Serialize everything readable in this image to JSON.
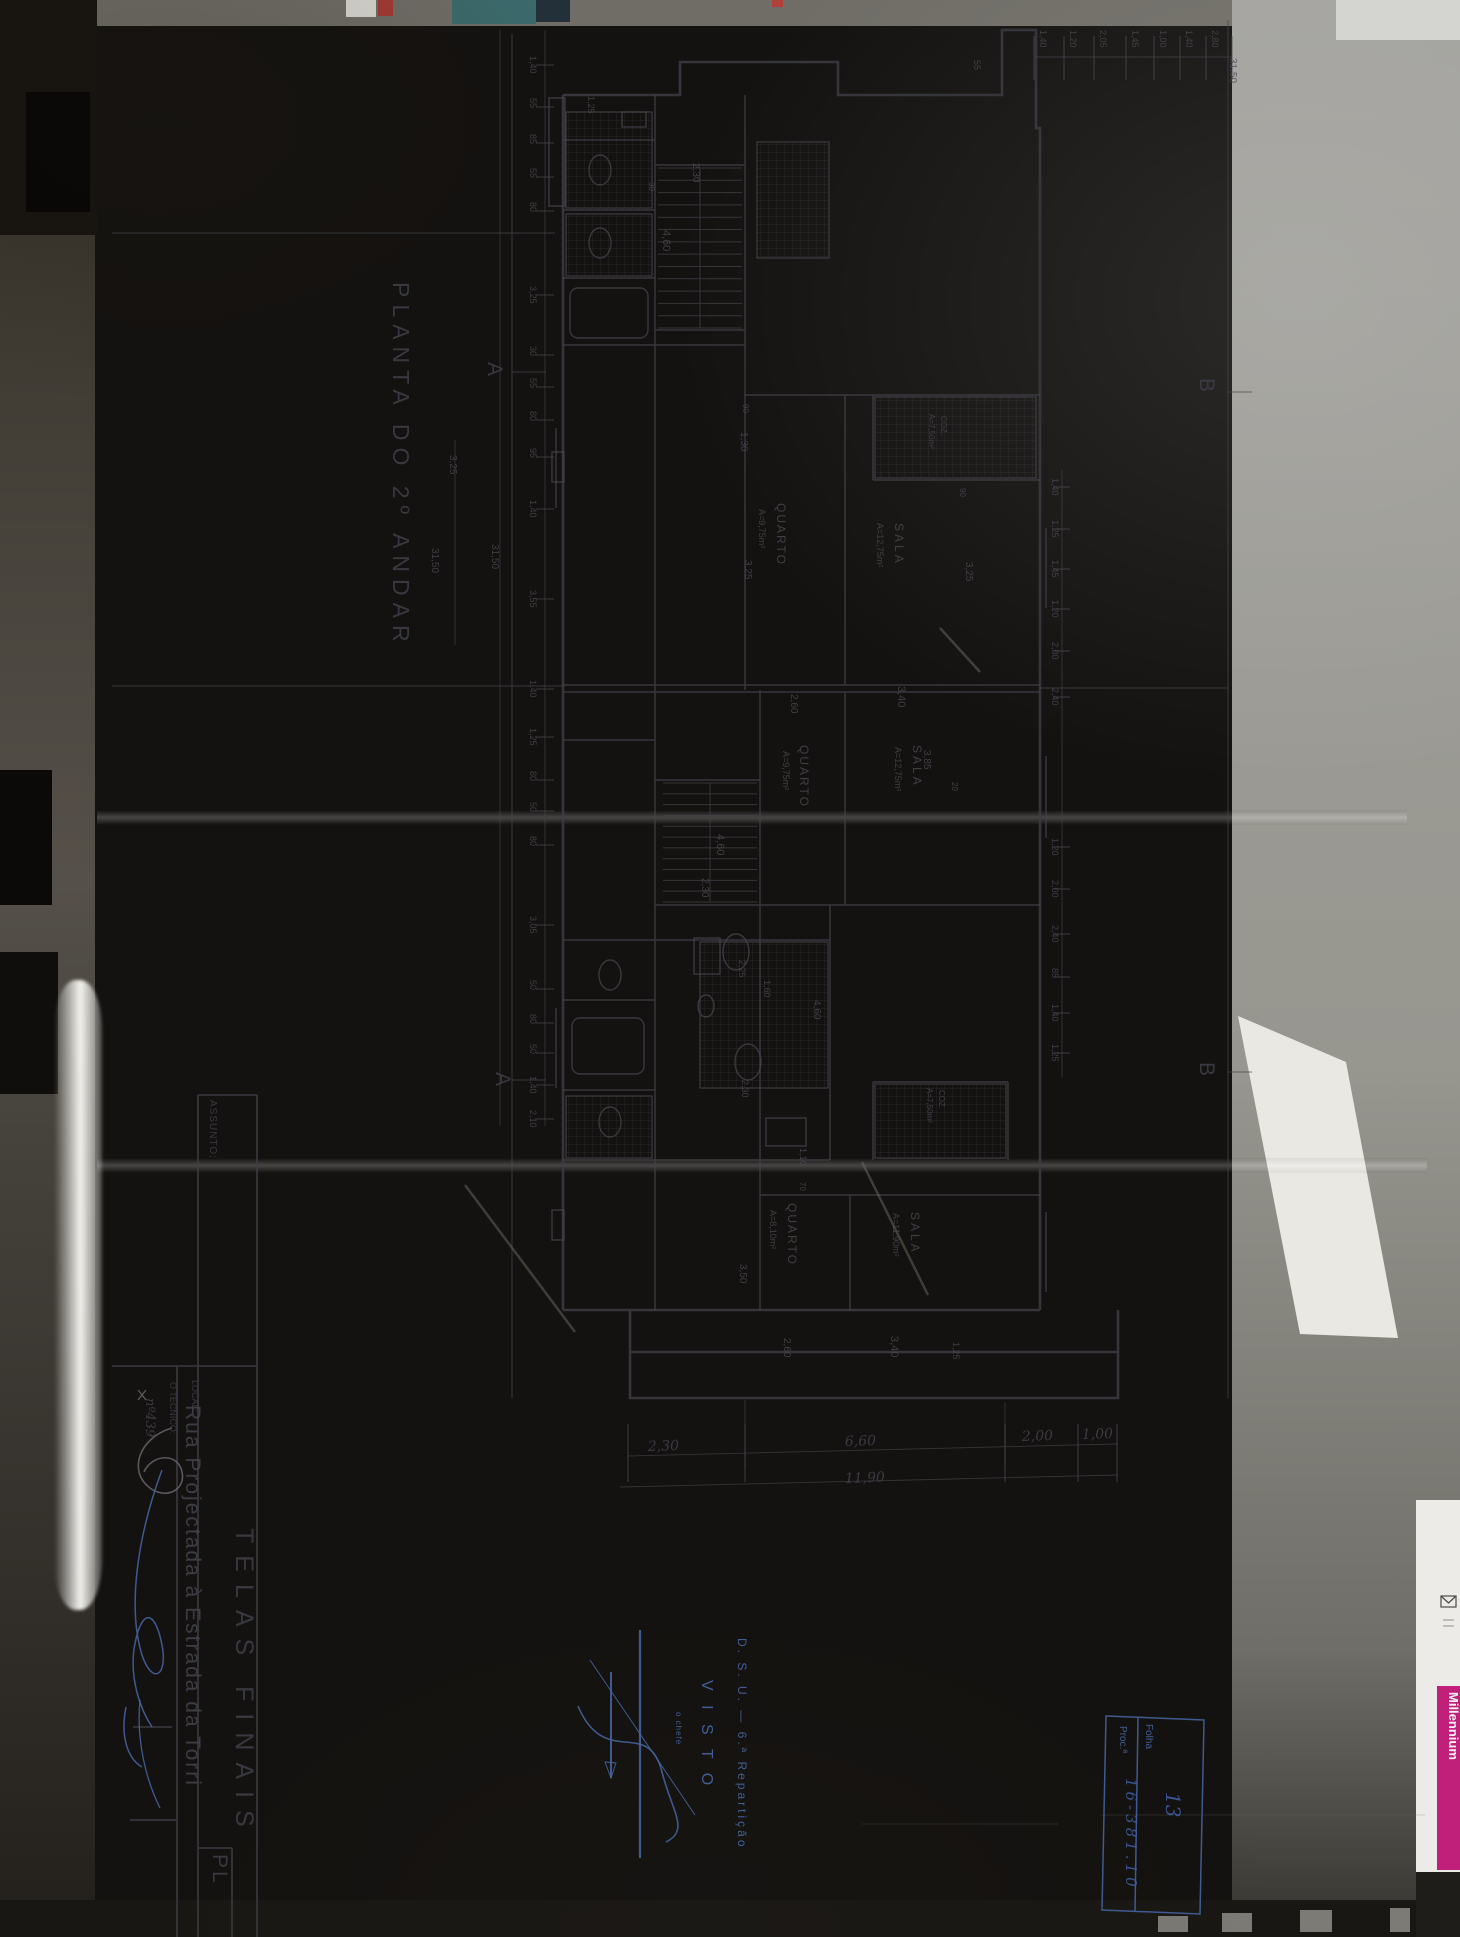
{
  "meta": {
    "sheet_title": "PLANTA DO 2º ANDAR",
    "document_type": "architectural floor plan photograph"
  },
  "colors": {
    "paper": "#bcb9ab",
    "ink": "#3f3f49",
    "stamp_blue": "#4667a5",
    "brand_magenta": "#c0207a"
  },
  "drawing": {
    "texts": [
      {
        "n": "plan-title",
        "t": "PLANTA  DO  2º  ANDAR",
        "x": 393,
        "y": 282,
        "s": 23,
        "ls": 7,
        "c": "ink"
      },
      {
        "n": "section-marker-a-top",
        "t": "A",
        "x": 488,
        "y": 362,
        "s": 21,
        "c": "ink"
      },
      {
        "n": "section-marker-a-bottom",
        "t": "A",
        "x": 496,
        "y": 1072,
        "s": 21,
        "c": "ink"
      },
      {
        "n": "section-marker-b-top",
        "t": "B",
        "x": 1200,
        "y": 378,
        "s": 21,
        "c": "ink"
      },
      {
        "n": "section-marker-b-bottom",
        "t": "B",
        "x": 1200,
        "y": 1062,
        "s": 21,
        "c": "ink"
      },
      {
        "n": "room-label",
        "t": "QUARTO",
        "x": 777,
        "y": 503,
        "s": 12,
        "ls": 2
      },
      {
        "n": "room-area",
        "t": "A=9,75m²",
        "x": 759,
        "y": 509,
        "s": 9
      },
      {
        "n": "room-label",
        "t": "SALA",
        "x": 895,
        "y": 523,
        "s": 12,
        "ls": 3
      },
      {
        "n": "room-area",
        "t": "A=12,75m²",
        "x": 877,
        "y": 523,
        "s": 9
      },
      {
        "n": "room-label",
        "t": "QUARTO",
        "x": 800,
        "y": 745,
        "s": 12,
        "ls": 2
      },
      {
        "n": "room-area",
        "t": "A=9,75m²",
        "x": 783,
        "y": 751,
        "s": 9
      },
      {
        "n": "room-label",
        "t": "SALA",
        "x": 913,
        "y": 745,
        "s": 12,
        "ls": 3
      },
      {
        "n": "room-area",
        "t": "A=12,75m²",
        "x": 895,
        "y": 747,
        "s": 9
      },
      {
        "n": "room-label",
        "t": "QUARTO",
        "x": 788,
        "y": 1203,
        "s": 12,
        "ls": 2
      },
      {
        "n": "room-area",
        "t": "A=8,10m²",
        "x": 770,
        "y": 1210,
        "s": 9
      },
      {
        "n": "room-label",
        "t": "SALA",
        "x": 911,
        "y": 1212,
        "s": 12,
        "ls": 3
      },
      {
        "n": "room-area",
        "t": "A=11,90m²",
        "x": 893,
        "y": 1213,
        "s": 9
      },
      {
        "n": "room-label",
        "t": "COZ.",
        "x": 941,
        "y": 416,
        "s": 8
      },
      {
        "n": "room-area",
        "t": "A=7,50m²",
        "x": 929,
        "y": 414,
        "s": 8
      },
      {
        "n": "room-label",
        "t": "COZ.",
        "x": 939,
        "y": 1090,
        "s": 8
      },
      {
        "n": "room-area",
        "t": "A=7,50m²",
        "x": 927,
        "y": 1088,
        "s": 8
      },
      {
        "n": "dim-label",
        "t": "2,30",
        "x": 693,
        "y": 163,
        "s": 10,
        "c": "pencil"
      },
      {
        "n": "dim-label",
        "t": "30",
        "x": 649,
        "y": 182,
        "s": 8,
        "c": "pencil"
      },
      {
        "n": "dim-label",
        "t": "4,60",
        "x": 663,
        "y": 230,
        "s": 11,
        "c": "pencil"
      },
      {
        "n": "dim-label",
        "t": "90",
        "x": 743,
        "y": 404,
        "s": 8,
        "c": "pencil"
      },
      {
        "n": "dim-label",
        "t": "1,30",
        "x": 741,
        "y": 432,
        "s": 10,
        "c": "pencil"
      },
      {
        "n": "dim-label",
        "t": "3,25",
        "x": 745,
        "y": 560,
        "s": 10,
        "c": "pencil"
      },
      {
        "n": "dim-label",
        "t": "90",
        "x": 960,
        "y": 488,
        "s": 8,
        "c": "pencil"
      },
      {
        "n": "dim-label",
        "t": "3,25",
        "x": 966,
        "y": 562,
        "s": 10,
        "c": "pencil"
      },
      {
        "n": "dim-label",
        "t": "20",
        "x": 952,
        "y": 782,
        "s": 8,
        "c": "pencil"
      },
      {
        "n": "dim-label",
        "t": "2,60",
        "x": 791,
        "y": 694,
        "s": 10,
        "c": "pencil"
      },
      {
        "n": "dim-label",
        "t": "3,40",
        "x": 898,
        "y": 686,
        "s": 11,
        "c": "pencil"
      },
      {
        "n": "dim-label",
        "t": "3,85",
        "x": 924,
        "y": 750,
        "s": 10,
        "c": "pencil"
      },
      {
        "n": "dim-label",
        "t": "4,60",
        "x": 717,
        "y": 834,
        "s": 11,
        "c": "pencil"
      },
      {
        "n": "dim-label",
        "t": "2,30",
        "x": 702,
        "y": 878,
        "s": 10,
        "c": "pencil"
      },
      {
        "n": "dim-label",
        "t": "2,25",
        "x": 739,
        "y": 960,
        "s": 9,
        "c": "pencil"
      },
      {
        "n": "dim-label",
        "t": "1,60",
        "x": 764,
        "y": 980,
        "s": 9,
        "c": "pencil"
      },
      {
        "n": "dim-label",
        "t": "4,60",
        "x": 814,
        "y": 1000,
        "s": 10,
        "c": "pencil"
      },
      {
        "n": "dim-label",
        "t": "2,30",
        "x": 742,
        "y": 1080,
        "s": 9,
        "c": "pencil"
      },
      {
        "n": "dim-label",
        "t": "1,10",
        "x": 800,
        "y": 1148,
        "s": 9,
        "c": "pencil"
      },
      {
        "n": "dim-label",
        "t": "70",
        "x": 800,
        "y": 1182,
        "s": 8,
        "c": "pencil"
      },
      {
        "n": "dim-label",
        "t": "3,50",
        "x": 740,
        "y": 1264,
        "s": 10,
        "c": "pencil"
      },
      {
        "n": "dim-label",
        "t": "2,60",
        "x": 784,
        "y": 1338,
        "s": 10,
        "c": "pencil"
      },
      {
        "n": "dim-label",
        "t": "3,40",
        "x": 891,
        "y": 1336,
        "s": 11,
        "c": "pencil"
      },
      {
        "n": "dim-label",
        "t": "1,25",
        "x": 953,
        "y": 1342,
        "s": 9,
        "c": "pencil"
      },
      {
        "n": "dim-label",
        "t": "55",
        "x": 974,
        "y": 60,
        "s": 9,
        "c": "pencil"
      },
      {
        "n": "dim-label",
        "t": "1,25",
        "x": 588,
        "y": 96,
        "s": 9,
        "c": "pencil"
      },
      {
        "n": "dim-total",
        "t": "31,50",
        "x": 492,
        "y": 544,
        "s": 10,
        "c": "pencil"
      },
      {
        "n": "dim-label",
        "t": "3,25",
        "x": 450,
        "y": 455,
        "s": 10,
        "c": "pencil"
      },
      {
        "n": "dim-total",
        "t": "31,50",
        "x": 432,
        "y": 548,
        "s": 10,
        "c": "pencil"
      }
    ],
    "chains": {
      "left": {
        "values": [
          "1,40",
          "55",
          "85",
          "55",
          "80",
          "3,25",
          "30",
          "55",
          "80",
          "95",
          "1,40",
          "3,55",
          "1,40",
          "1,25",
          "80",
          "50",
          "80",
          "3,05",
          "50",
          "80",
          "50",
          "1,40",
          "2,10"
        ],
        "ys": [
          56,
          98,
          134,
          168,
          202,
          286,
          346,
          378,
          411,
          448,
          500,
          590,
          680,
          728,
          771,
          802,
          836,
          916,
          980,
          1014,
          1044,
          1076,
          1110
        ],
        "label_x": 530,
        "line_x": 545,
        "total": "31,50"
      },
      "top": {
        "values": [
          "1,40",
          "1,20",
          "2,05",
          "1,45",
          "1,00",
          "1,40",
          "2,80"
        ],
        "xs": [
          1040,
          1070,
          1100,
          1132,
          1160,
          1186,
          1212
        ],
        "label_y": 30,
        "line_y": 57,
        "total": "31,50",
        "total_x": 1230,
        "total_y": 58
      },
      "right": {
        "values": [
          "1,40",
          "1,25",
          "1,45",
          "1,20",
          "2,00",
          "2,40",
          "1,20",
          "2,00",
          "2,40",
          "85",
          "1,40",
          "1,25"
        ],
        "ys": [
          478,
          520,
          560,
          600,
          642,
          688,
          838,
          880,
          925,
          968,
          1004,
          1044
        ],
        "label_x": 1052,
        "line_x": 1062
      },
      "bottom": {
        "values": [
          "2,30",
          "6,60",
          "2,00",
          "1,00"
        ],
        "xs": [
          648,
          845,
          1022,
          1082
        ],
        "label_y": [
          1451,
          1446,
          1441,
          1439
        ],
        "tick_xs": [
          628,
          745,
          1005,
          1078,
          1117
        ],
        "total": "11,90",
        "total_x": 845,
        "total_y": 1483
      }
    }
  },
  "title_block": {
    "texts": [
      {
        "n": "assunto-label",
        "t": "ASSUNTO:",
        "x": 210,
        "y": 1100,
        "s": 10,
        "ls": 1,
        "c": "ink"
      },
      {
        "n": "assunto-value",
        "t": "TELAS  FINAIS",
        "x": 236,
        "y": 1528,
        "s": 25,
        "ls": 12,
        "c": "ink"
      },
      {
        "n": "local-label",
        "t": "LOCAL:",
        "x": 192,
        "y": 1380,
        "s": 9,
        "c": "ink"
      },
      {
        "n": "local-value",
        "t": "Rua  Projectada  à  Estrada  da  Torri",
        "x": 186,
        "y": 1405,
        "s": 21,
        "ls": 2,
        "c": "ink2"
      },
      {
        "n": "tecnico-label",
        "t": "O TÉCNICO:",
        "x": 170,
        "y": 1382,
        "s": 9,
        "c": "ink"
      },
      {
        "n": "tecnico-number",
        "t": "nº439",
        "x": 146,
        "y": 1398,
        "s": 13,
        "c": "hand"
      },
      {
        "n": "sheet-code",
        "t": "PL",
        "x": 213,
        "y": 1854,
        "s": 21,
        "ls": 3,
        "c": "ink"
      }
    ]
  },
  "stamps": {
    "texts": [
      {
        "n": "stamp-org",
        "t": "D. S. U. — 6.ª Repartição",
        "x": 738,
        "y": 1638,
        "s": 12,
        "ls": 3,
        "c": "blue"
      },
      {
        "n": "stamp-visto",
        "t": "V I S T O",
        "x": 702,
        "y": 1680,
        "s": 16,
        "ls": 5,
        "c": "blue"
      },
      {
        "n": "stamp-chefe",
        "t": "o chefe",
        "x": 676,
        "y": 1712,
        "s": 8,
        "ls": 1,
        "c": "blue"
      },
      {
        "n": "folha-label",
        "t": "Folha",
        "x": 1146,
        "y": 1724,
        "s": 10,
        "c": "blue"
      },
      {
        "n": "folha-value",
        "t": "13",
        "x": 1166,
        "y": 1792,
        "s": 20,
        "c": "blueink"
      },
      {
        "n": "proc-label",
        "t": "Proc.ª",
        "x": 1120,
        "y": 1726,
        "s": 10,
        "c": "blue"
      },
      {
        "n": "proc-value",
        "t": "16-381.10",
        "x": 1126,
        "y": 1778,
        "s": 15,
        "ls": 4,
        "c": "blueink"
      }
    ]
  },
  "surroundings": {
    "texts": [
      {
        "n": "brand-card-label",
        "t": "Millennium",
        "x": 1449,
        "y": 1692,
        "s": 13,
        "c": "wht"
      }
    ]
  }
}
